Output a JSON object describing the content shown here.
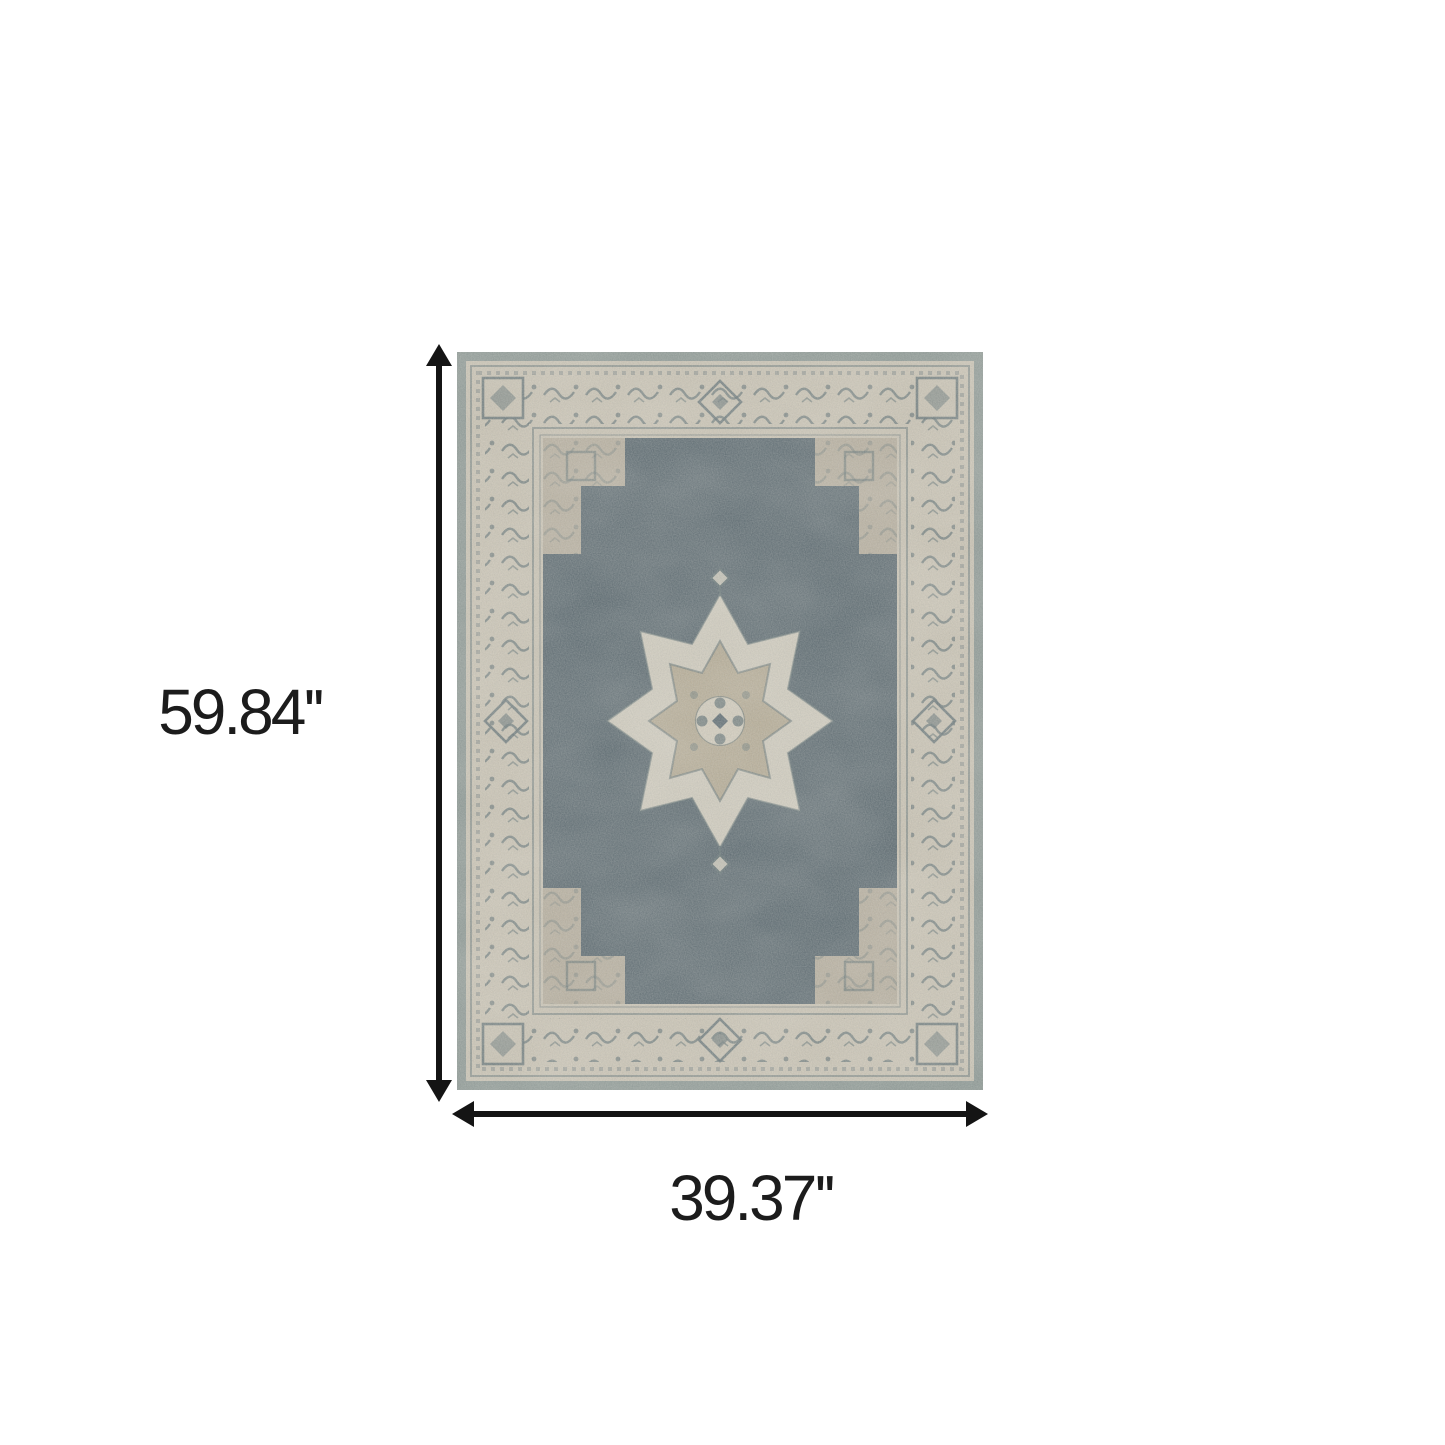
{
  "page": {
    "background_color": "#ffffff",
    "kind": "product dimension diagram"
  },
  "dimension_annotation": {
    "height_label": "59.84''",
    "width_label": "39.37''",
    "arrow_color": "#141414",
    "label_color": "#1c1c1c"
  },
  "rug": {
    "description": "Distressed vintage-style oriental area rug with slate blue stepped field, beige ornate border and cream center medallion",
    "colors": {
      "edge_band": "#87938f",
      "border_cream": "#cbc3b2",
      "inner_beige": "#b6ac9a",
      "field": "#4f5e66",
      "medallion_cream": "#d7d0c0",
      "medallion_tan": "#b3a78e",
      "motif": "#5a6a6d"
    }
  }
}
